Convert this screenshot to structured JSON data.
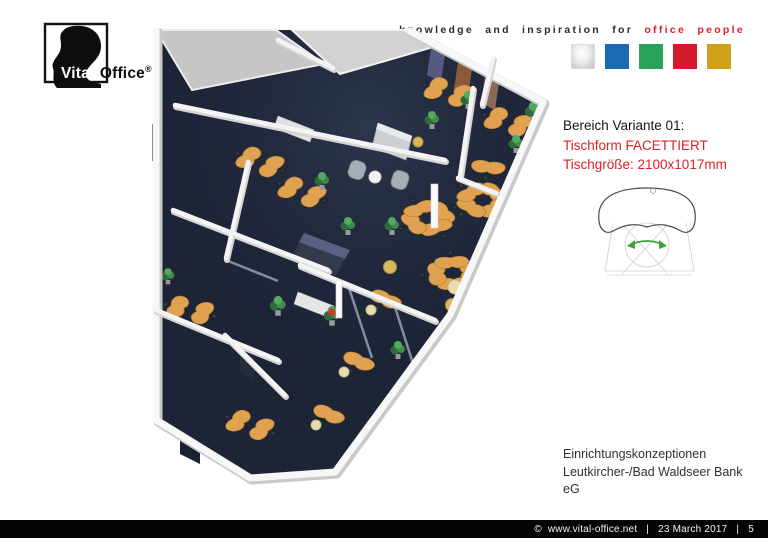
{
  "slide": {
    "background": "#ffffff"
  },
  "logo": {
    "brand_prefix": "Vital-",
    "brand_suffix": "Office",
    "registered_mark": "®"
  },
  "header": {
    "tagline": {
      "black_text": "knowledge and inspiration for",
      "red_text": "office people"
    },
    "color_squares": [
      {
        "name": "silver",
        "color": "#e0e0e0",
        "gradient": true
      },
      {
        "name": "blue",
        "color": "#1b6ab3"
      },
      {
        "name": "green",
        "color": "#2aa259"
      },
      {
        "name": "red",
        "color": "#d41a2c"
      },
      {
        "name": "gold",
        "color": "#d0a118"
      }
    ]
  },
  "variant_annotation": {
    "title": "Bereich Variante 01:",
    "table_shape": "Tischform FACETTIERT",
    "table_size": "Tischgröße: 2100x1017mm",
    "accent_color": "#de2126"
  },
  "project_caption": {
    "line1": "Einrichtungskonzeptionen",
    "line2": "Leutkircher-/Bad Waldseer Bank",
    "line3": "eG"
  },
  "footer": {
    "copyright_symbol": "©",
    "website": "www.vital-office.net",
    "separator": "|",
    "date": "23 March 2017",
    "page_number": "5"
  },
  "render": {
    "description": "3D isometric rendering of an open-plan bank office: dark blue carpet, white cut-away walls, glass partitions, facetted wooden desks in pinwheel clusters, black task chairs, green plants, reception counter and lounge seating.",
    "floor_color": "#1d2436",
    "desk_color": "#e0a251",
    "wall_color": "#f5f5f5"
  }
}
